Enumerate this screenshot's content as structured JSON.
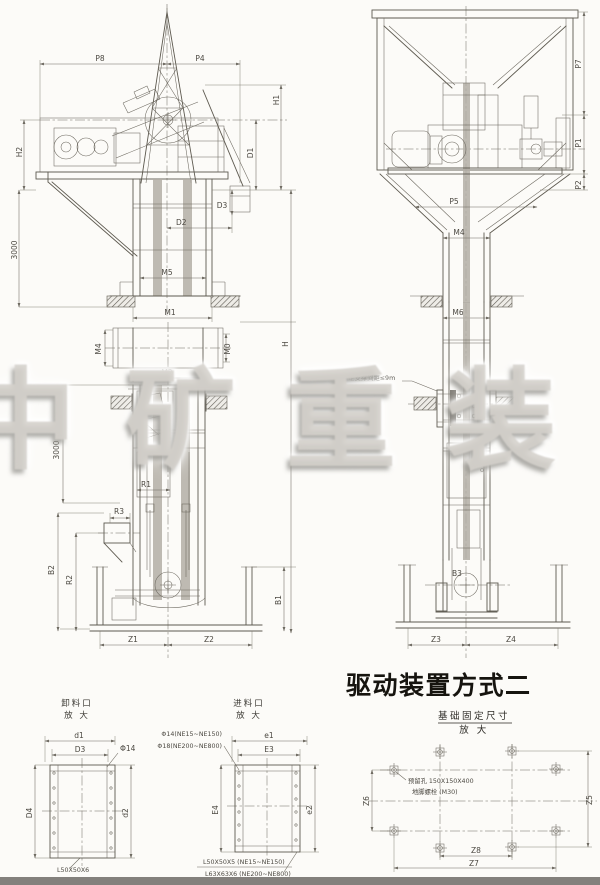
{
  "watermark": {
    "text": "中矿重装"
  },
  "section_title": "驱动装置方式二",
  "head_side": {
    "p8": "P8",
    "p4": "P4",
    "h1": "H1",
    "h2": "H2",
    "d1": "D1",
    "d3": "D3",
    "d2": "D2",
    "v3000": "3000",
    "m5": "M5",
    "m1": "M1"
  },
  "boot_side": {
    "m4": "M4",
    "m0": "M0",
    "m2": "M2",
    "v3000": "3000",
    "r1": "R1",
    "r3": "R3",
    "b2": "B2",
    "r2": "R2",
    "b1": "B1",
    "h": "H",
    "z1": "Z1",
    "z2": "Z2"
  },
  "head_front": {
    "p7": "P7",
    "p1": "P1",
    "p2": "P2",
    "p5": "P5",
    "m4": "M4"
  },
  "casing_front": {
    "m6": "M6",
    "b3": "B3",
    "z3": "Z3",
    "z4": "Z4",
    "support_note1": "固定支撑间距≤9m",
    "support_note2": "或随楼层固定"
  },
  "discharge_detail": {
    "title1": "卸料口",
    "title2": "放 大",
    "d1": "d1",
    "d3": "D3",
    "d4": "D4",
    "d2": "d2",
    "hole": "Φ14",
    "angle": "L50X50X6"
  },
  "inlet_detail": {
    "title1": "进料口",
    "title2": "放 大",
    "hole1": "Φ14(NE15~NE150)",
    "hole2": "Φ18(NE200~NE800)",
    "e1": "e1",
    "e3": "E3",
    "e4": "E4",
    "e2": "e2",
    "angle1": "L50X50X5 (NE15~NE150)",
    "angle2": "L63X63X6 (NE200~NE800)"
  },
  "foundation": {
    "title1": "基础固定尺寸",
    "title2": "放 大",
    "note1": "预留孔 150X150X400",
    "note2": "地脚螺栓 (M30)",
    "z6": "Z6",
    "z5": "Z5",
    "z8": "Z8",
    "z7": "Z7"
  }
}
